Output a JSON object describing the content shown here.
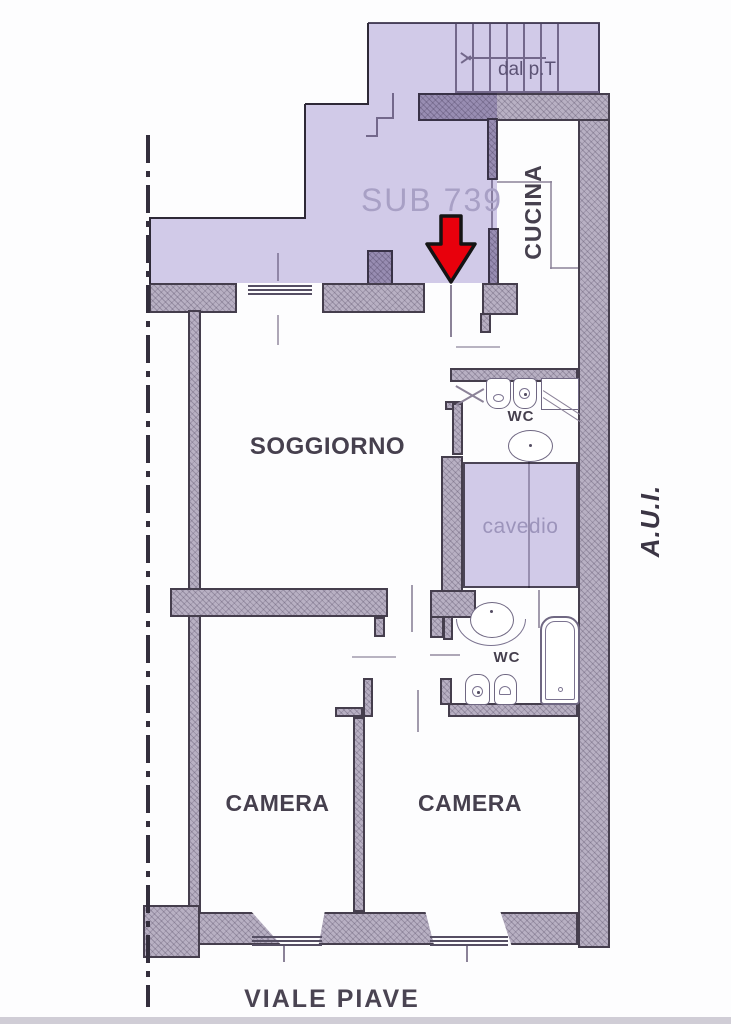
{
  "document": {
    "type": "floor-plan",
    "style": "scanned cadastral drawing"
  },
  "labels": {
    "annex": "SUB 739",
    "stairs": "dal p.T",
    "kitchen": "CUCINA",
    "living_room": "SOGGIORNO",
    "wc_upper": "WC",
    "shaft": "cavedio",
    "wc_lower": "WC",
    "bedroom_left": "CAMERA",
    "bedroom_right": "CAMERA",
    "right_margin": "A.U.I.",
    "street": "VIALE PIAVE"
  },
  "marker": {
    "type": "entrance-arrow",
    "direction": "down",
    "color": "#e8000c"
  },
  "colors": {
    "overlay_purple": "#d3cce9",
    "wall_fill": "#b8b0c3",
    "wall_outline": "#453e4d",
    "thin_line": "#8b8298",
    "text_dark": "#46404e",
    "text_purple": "#a8a0c5",
    "arrow_red": "#e8000c",
    "background": "#fdfdfe"
  }
}
